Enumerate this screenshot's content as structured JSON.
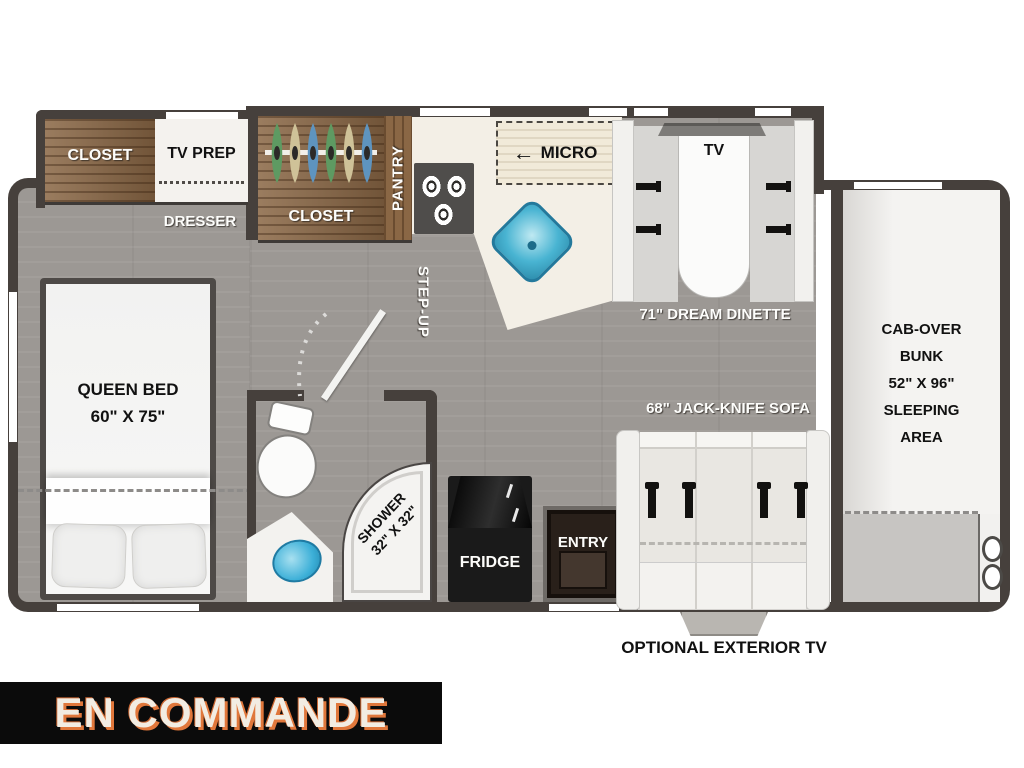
{
  "plan": {
    "bedroom": {
      "closet": "CLOSET",
      "tv_prep": "TV PREP",
      "dresser": "DRESSER",
      "bed_line1": "QUEEN BED",
      "bed_line2": "60\" X 75\""
    },
    "kitchen": {
      "closet": "CLOSET",
      "pantry": "PANTRY",
      "micro": "MICRO",
      "micro_arrow": "←"
    },
    "bathroom": {
      "shower_line1": "SHOWER",
      "shower_line2": "32\" X 32\""
    },
    "hall": {
      "step_up": "STEP-UP",
      "fridge": "FRIDGE",
      "entry": "ENTRY"
    },
    "dinette": {
      "tv": "TV",
      "label": "71\" DREAM DINETTE"
    },
    "sofa": {
      "label": "68\" JACK-KNIFE SOFA",
      "exterior_tv": "OPTIONAL EXTERIOR TV"
    },
    "cab_over": {
      "lines": [
        "CAB-OVER",
        "BUNK",
        "52\" X 96\"",
        "SLEEPING",
        "AREA"
      ]
    }
  },
  "banner": {
    "text": "EN COMMANDE"
  },
  "colors": {
    "wall": "#46403c",
    "floor": "#9c9894",
    "wood": "#8a6745",
    "counter": "#f3efe6",
    "sink_teal": "#46b4d3",
    "stove": "#4f4d4b",
    "fridge": "#191919",
    "entry_door": "#29201a",
    "banner_bg": "#0b0b0b",
    "banner_text": "#f2ece2",
    "banner_shadow": "#e0773b"
  }
}
